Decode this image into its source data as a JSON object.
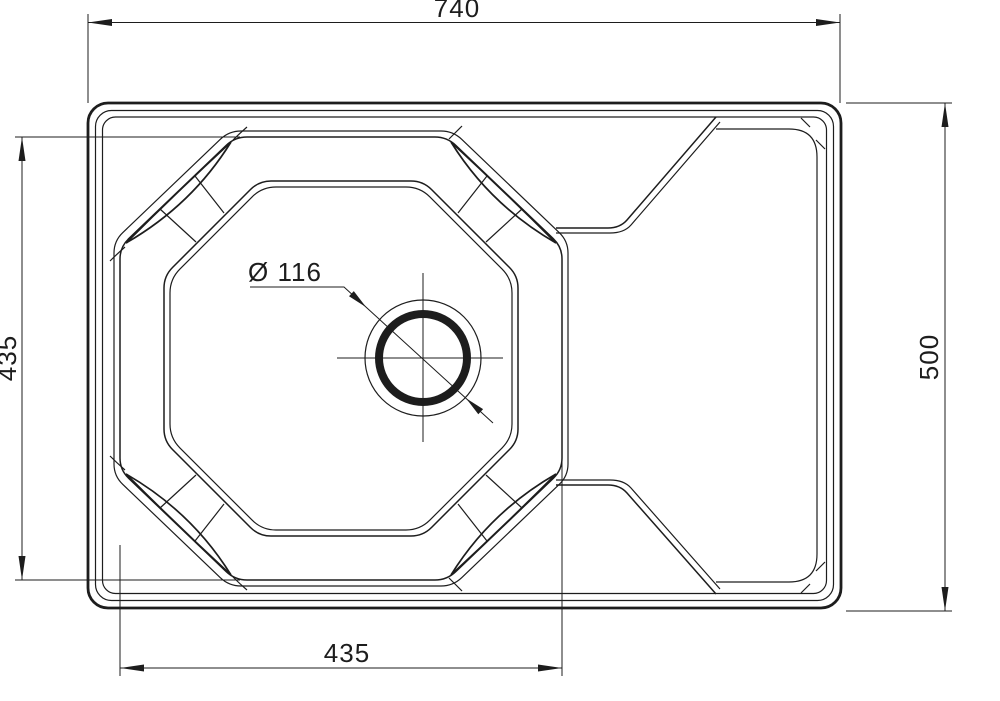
{
  "drawing": {
    "subject": "Kitchen sink with drainboard - top view technical drawing",
    "background_color": "#ffffff",
    "line_color": "#1d1d1d",
    "dimensions": {
      "overall_width": "740",
      "overall_depth": "500",
      "bowl_width": "435",
      "bowl_depth": "435",
      "drain_diameter": "Ø 116"
    }
  }
}
